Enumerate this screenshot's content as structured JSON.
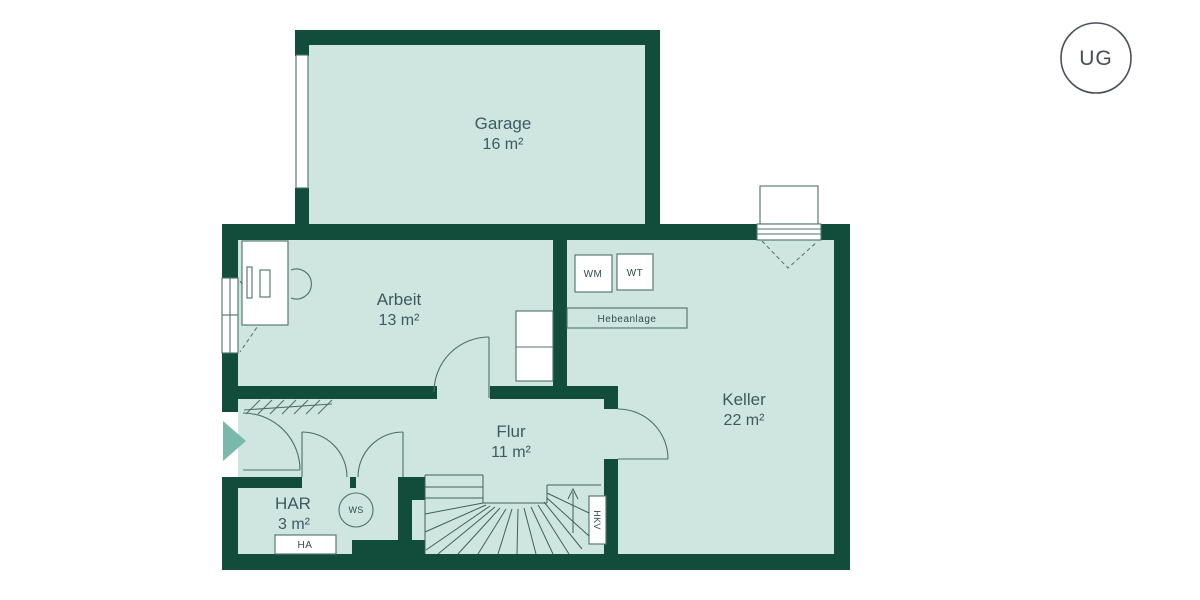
{
  "floor_badge": {
    "label": "UG"
  },
  "rooms": [
    {
      "name": "Garage",
      "area": "16 m²"
    },
    {
      "name": "Arbeit",
      "area": "13 m²"
    },
    {
      "name": "Keller",
      "area": "22 m²"
    },
    {
      "name": "Flur",
      "area": "11 m²"
    },
    {
      "name": "HAR",
      "area": "3 m²"
    }
  ],
  "equipment": {
    "washing_machine": "WM",
    "dryer": "WT",
    "lifting_station": "Hebeanlage",
    "house_connection": "HA",
    "water_softener": "WS",
    "heating_circuit_distributor": "HKV"
  },
  "colors": {
    "wall": "#114d3a",
    "floor": "#cfe6e0",
    "outline": "#4c7069",
    "label_text": "#3c5a64",
    "entrance_arrow": "#7ab8ac",
    "badge_border": "#4b515a",
    "background": "#ffffff"
  }
}
